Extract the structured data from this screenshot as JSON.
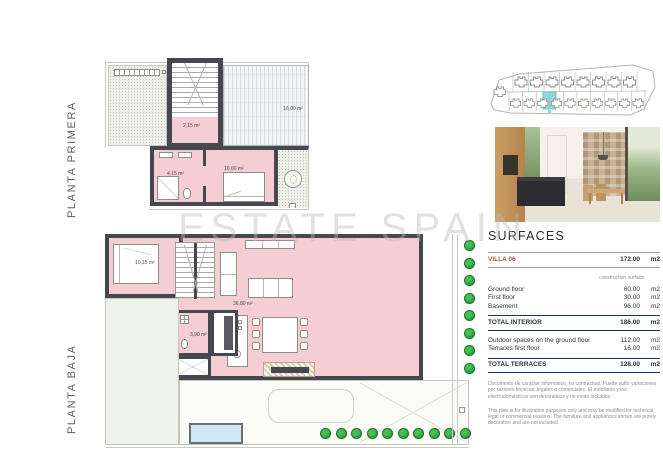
{
  "watermark": {
    "text": "ESTATE SPAIN"
  },
  "plans": {
    "primera": {
      "label": "PLANTA PRIMERA",
      "rooms": {
        "stairs_landing": "2,15 m²",
        "bathroom": "4,15 m²",
        "bedroom": "10,00 m²",
        "terrace": "16,00 m²"
      }
    },
    "baja": {
      "label": "PLANTA BAJA",
      "rooms": {
        "bedroom": "10,15 m²",
        "bathroom": "3,90 m²",
        "living": "36,80 m²"
      }
    }
  },
  "surfaces": {
    "title": "SURFACES",
    "villa": {
      "name": "VILLA 06",
      "value": "172.00",
      "unit": "m2"
    },
    "column_note": "construction surface",
    "rows": [
      {
        "label": "Ground floor",
        "value": "60.00",
        "unit": "m2"
      },
      {
        "label": "First floor",
        "value": "30.00",
        "unit": "m2"
      },
      {
        "label": "Basement",
        "value": "96.00",
        "unit": "m2"
      }
    ],
    "total_interior": {
      "label": "TOTAL INTERIOR",
      "value": "186.00",
      "unit": "m2"
    },
    "outdoor_rows": [
      {
        "label": "Outdoor spaces on the ground floor",
        "value": "112.00",
        "unit": "m2"
      },
      {
        "label": "Terraces first floor",
        "value": "16.00",
        "unit": "m2"
      }
    ],
    "total_terraces": {
      "label": "TOTAL TERRACES",
      "value": "128.00",
      "unit": "m2"
    },
    "disclaimer_es": "Documento de carácter informativo, no contractual. Puede sufrir variaciones por razones técnicas, legales o comerciales. El mobiliario y los electrodomésticos son decorativos y no están incluidos.",
    "disclaimer_en": "This plan is for illustration purposes only and may be modified for technical, legal or commercial reasons. The furniture and appliances shown are purely decorative and are not included."
  },
  "colors": {
    "wall": "#474750",
    "pink": "#f4ced2",
    "red": "#b5534d",
    "navy": "#17365d",
    "green": "#2f9e41",
    "accent": "#8fd8e0"
  }
}
